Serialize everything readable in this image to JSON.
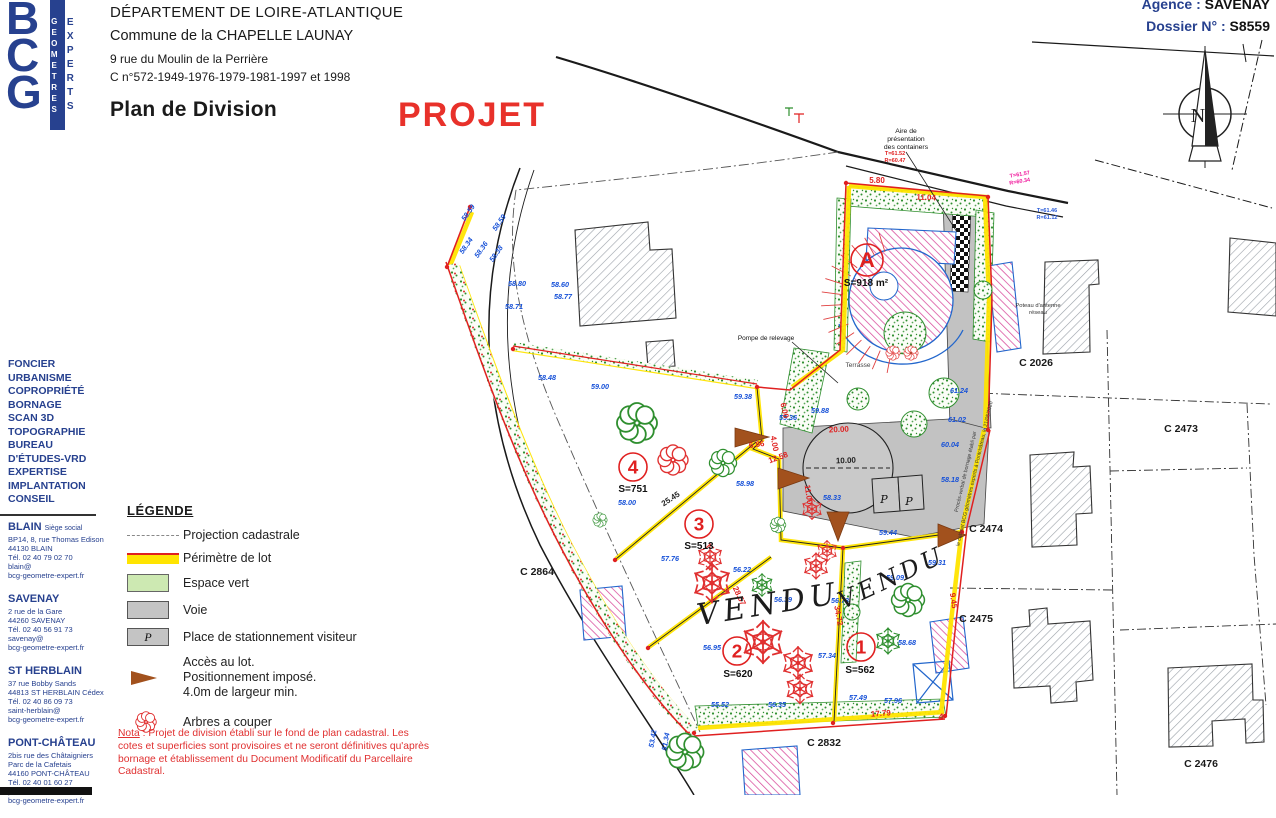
{
  "colors": {
    "brand_blue": "#27418f",
    "stamp_red": "#e8312a",
    "perimeter_yellow": "#ffe400",
    "boundary_red": "#e02020",
    "hedge_green": "#2f8f2f",
    "voie_gray": "#c2c2c2",
    "elevation_blue": "#1550d8",
    "building_pink": "#d84a9b",
    "access_brown": "#a2511d"
  },
  "header": {
    "logo": {
      "monogram": "BCG",
      "vertical_left": "GEOMETRES",
      "vertical_right": "EXPERTS"
    },
    "department": "DÉPARTEMENT DE LOIRE-ATLANTIQUE",
    "commune": "Commune de la CHAPELLE LAUNAY",
    "address": "9 rue du Moulin de la Perrière",
    "cadastre_refs": "C n°572-1949-1976-1979-1981-1997 et 1998",
    "title": "Plan de Division",
    "stamp": "PROJET",
    "agency_label": "Agence :",
    "agency_value": "SAVENAY",
    "dossier_label": "Dossier N° :",
    "dossier_value": "S8559"
  },
  "sidebar": {
    "services": [
      "FONCIER",
      "URBANISME",
      "COPROPRIÉTÉ",
      "BORNAGE",
      "SCAN 3D",
      "TOPOGRAPHIE",
      "BUREAU",
      "D'ÉTUDES-VRD",
      "EXPERTISE",
      "IMPLANTATION",
      "CONSEIL"
    ],
    "offices": [
      {
        "city": "BLAIN",
        "suffix": "Siège social",
        "lines": [
          "BP14, 8, rue Thomas Edison",
          "44130 BLAIN",
          "Tél. 02 40 79 02 70",
          "blain@",
          "bcg-geometre-expert.fr"
        ]
      },
      {
        "city": "SAVENAY",
        "suffix": "",
        "lines": [
          "2 rue de la Gare",
          "44260 SAVENAY",
          "Tél. 02 40 56 91 73",
          "savenay@",
          "bcg-geometre-expert.fr"
        ]
      },
      {
        "city": "ST HERBLAIN",
        "suffix": "",
        "lines": [
          "37 rue Bobby Sands",
          "44813 ST HERBLAIN Cédex",
          "Tél. 02 40 86 09 73",
          "saint-herblain@",
          "bcg-geometre-expert.fr"
        ]
      },
      {
        "city": "PONT-CHÂTEAU",
        "suffix": "",
        "lines": [
          "2bis rue des Châtaigniers",
          "Parc de la Cafetais",
          "44160 PONT-CHÂTEAU",
          "Tél. 02 40 01 60 27",
          "pontchateau@",
          "bcg-geometre-expert.fr"
        ]
      }
    ]
  },
  "legend": {
    "title": "LÉGENDE",
    "p_char": "P",
    "items": [
      {
        "icon": "dash",
        "label": "Projection cadastrale"
      },
      {
        "icon": "band",
        "label": "Périmètre de lot"
      },
      {
        "icon": "green",
        "label": "Espace vert"
      },
      {
        "icon": "gray",
        "label": "Voie"
      },
      {
        "icon": "p",
        "label": "Place de stationnement visiteur"
      },
      {
        "icon": "arrow",
        "lines": [
          "Accès au lot.",
          "Positionnement imposé.",
          "4.0m de largeur min."
        ]
      },
      {
        "icon": "flower",
        "label": "Arbres a couper"
      }
    ]
  },
  "nota": {
    "label": "Nota",
    "body": " : Projet de division établi sur le fond de plan cadastral. Les cotes et superficies sont provisoires et ne seront définitives qu'après bornage et établissement du Document Modificatif du Parcellaire Cadastral."
  },
  "plan": {
    "north": "N",
    "lots": [
      {
        "id": "A",
        "area": "S=918 m²",
        "cx": 867,
        "cy": 260,
        "r": 16,
        "ax": 866,
        "ay": 286
      },
      {
        "id": "4",
        "area": "S=751",
        "cx": 633,
        "cy": 467,
        "r": 14,
        "ax": 633,
        "ay": 492
      },
      {
        "id": "3",
        "area": "S=513",
        "cx": 699,
        "cy": 524,
        "r": 14,
        "ax": 699,
        "ay": 549
      },
      {
        "id": "2",
        "area": "S=620",
        "cx": 737,
        "cy": 651,
        "r": 14,
        "ax": 738,
        "ay": 677
      },
      {
        "id": "1",
        "area": "S=562",
        "cx": 861,
        "cy": 647,
        "r": 14,
        "ax": 860,
        "ay": 673
      }
    ],
    "parcels": [
      [
        "C 2026",
        1036,
        366
      ],
      [
        "C 2473",
        1181,
        432
      ],
      [
        "C 2474",
        986,
        532
      ],
      [
        "C 2475",
        976,
        622
      ],
      [
        "C 2476",
        1201,
        767
      ],
      [
        "C 2832",
        824,
        746
      ],
      [
        "C 2864",
        537,
        575
      ]
    ],
    "annotations": [
      {
        "t": "Aire de",
        "x": 906,
        "y": 133,
        "s": 6.8
      },
      {
        "t": "présentation",
        "x": 906,
        "y": 141,
        "s": 6.8
      },
      {
        "t": "des containers",
        "x": 906,
        "y": 149,
        "s": 6.8
      },
      {
        "t": "Pompe de relevage",
        "x": 766,
        "y": 340,
        "s": 6.5
      },
      {
        "t": "Terrasse",
        "x": 858,
        "y": 367,
        "s": 6.5,
        "c": "#444"
      },
      {
        "t": "Poteau d'antenne",
        "x": 1038,
        "y": 307,
        "s": 5.8,
        "c": "#333"
      },
      {
        "t": "réseau",
        "x": 1038,
        "y": 314,
        "s": 5.8,
        "c": "#333"
      },
      {
        "t": "VENDU",
        "x": 770,
        "y": 614,
        "s": 30,
        "r": -9,
        "f": "DejaVu Serif, serif",
        "i": 1,
        "ls": 5,
        "c": "#1c1c1c"
      },
      {
        "t": "VENDU",
        "x": 895,
        "y": 585,
        "s": 24,
        "r": -25,
        "f": "DejaVu Serif, serif",
        "i": 1,
        "ls": 4,
        "c": "#1c1c1c"
      },
      {
        "t": "Procès-verbal de bornage établi par",
        "x": 967,
        "y": 472,
        "s": 5.2,
        "r": -77,
        "c": "#333"
      },
      {
        "t": "le cabinet BCG géomètres experts à Pontchâteau, le 21/05/2020",
        "x": 976,
        "y": 474,
        "s": 5.2,
        "r": -77,
        "c": "#333"
      },
      {
        "t": "P",
        "x": 884,
        "y": 503,
        "s": 11,
        "f": "DejaVu Serif, serif",
        "i": 1
      },
      {
        "t": "P",
        "x": 909,
        "y": 505,
        "s": 11,
        "f": "DejaVu Serif, serif",
        "i": 1
      }
    ],
    "measures": [
      [
        "5.80",
        877,
        183,
        0
      ],
      [
        "11.04",
        926,
        200,
        3
      ],
      [
        "T=61.52",
        895,
        155,
        0,
        5.5
      ],
      [
        "R=60.47",
        895,
        162,
        0,
        5.5
      ],
      [
        "T=61.57",
        1020,
        176,
        -10,
        5.5,
        "#f0189c"
      ],
      [
        "R=60.34",
        1020,
        183,
        -10,
        5.5,
        "#f0189c"
      ],
      [
        "T=61.46",
        1047,
        212,
        0,
        5.5,
        "#2659d8"
      ],
      [
        "R=61.12",
        1047,
        219,
        0,
        5.5,
        "#2659d8"
      ],
      [
        "6.00",
        782,
        411,
        78
      ],
      [
        "4.00",
        772,
        444,
        80
      ],
      [
        "6.86",
        757,
        447,
        -8
      ],
      [
        "12.58",
        779,
        460,
        -20
      ],
      [
        "11.00",
        806,
        495,
        82
      ],
      [
        "20.00",
        839,
        432,
        -3
      ],
      [
        "28.57",
        737,
        597,
        64
      ],
      [
        "34.72",
        836,
        616,
        80
      ],
      [
        "9.45",
        951,
        601,
        82
      ],
      [
        "17.79",
        881,
        716,
        -4
      ],
      [
        "4",
        941,
        720,
        0,
        9
      ],
      [
        "25.45",
        672,
        501,
        -33,
        8,
        "#222"
      ],
      [
        "10.00",
        846,
        463,
        -2,
        8,
        "#222"
      ]
    ],
    "elevations": [
      [
        "58.59",
        470,
        214,
        -55
      ],
      [
        "58.59",
        501,
        224,
        -55
      ],
      [
        "58.34",
        468,
        247,
        -55
      ],
      [
        "58.36",
        483,
        251,
        -55
      ],
      [
        "58.38",
        498,
        255,
        -55
      ],
      [
        "58.80",
        517,
        286,
        0
      ],
      [
        "58.71",
        514,
        309,
        0
      ],
      [
        "58.60",
        560,
        287,
        0
      ],
      [
        "58.77",
        563,
        299,
        0
      ],
      [
        "58.48",
        547,
        380,
        0
      ],
      [
        "59.00",
        600,
        389,
        0
      ],
      [
        "59.38",
        743,
        399,
        0
      ],
      [
        "59.36",
        788,
        420,
        0
      ],
      [
        "59.88",
        820,
        413,
        0
      ],
      [
        "58.98",
        745,
        486,
        0
      ],
      [
        "58.00",
        627,
        505,
        0
      ],
      [
        "57.76",
        670,
        561,
        0
      ],
      [
        "56.22",
        742,
        572,
        0
      ],
      [
        "56.39",
        783,
        602,
        0
      ],
      [
        "56.73",
        840,
        603,
        0
      ],
      [
        "56.95",
        712,
        650,
        0
      ],
      [
        "57.34",
        827,
        658,
        0
      ],
      [
        "58.68",
        907,
        645,
        0
      ],
      [
        "55.52",
        720,
        707,
        0
      ],
      [
        "56.35",
        777,
        707,
        0
      ],
      [
        "57.49",
        858,
        700,
        0
      ],
      [
        "57.96",
        893,
        703,
        0
      ],
      [
        "59.31",
        937,
        565,
        0
      ],
      [
        "59.09",
        895,
        580,
        0
      ],
      [
        "61.02",
        957,
        422,
        0
      ],
      [
        "60.04",
        950,
        447,
        0
      ],
      [
        "58.18",
        950,
        482,
        0
      ],
      [
        "59.44",
        888,
        535,
        0
      ],
      [
        "58.33",
        832,
        500,
        0
      ],
      [
        "61.24",
        959,
        393,
        0
      ],
      [
        "53.42",
        655,
        739,
        -80
      ],
      [
        "51.34",
        668,
        742,
        -80
      ]
    ],
    "trees": [
      [
        "snow",
        "#e03030",
        712,
        583,
        1.2
      ],
      [
        "snow",
        "#e03030",
        763,
        642,
        1.3
      ],
      [
        "snow",
        "#e03030",
        798,
        663,
        1.0
      ],
      [
        "snow",
        "#e03030",
        816,
        566,
        0.8
      ],
      [
        "snow",
        "#e03030",
        800,
        689,
        0.9
      ],
      [
        "snow",
        "#e03030",
        710,
        557,
        0.8
      ],
      [
        "snow",
        "#e03030",
        827,
        551,
        0.65
      ],
      [
        "snow",
        "#e03030",
        812,
        509,
        0.65
      ],
      [
        "snow",
        "#2f8f2f",
        762,
        585,
        0.7
      ],
      [
        "snow",
        "#2f8f2f",
        888,
        641,
        0.8
      ],
      [
        "flower",
        "#2f8f2f",
        637,
        423,
        1.4
      ],
      [
        "flower",
        "#2f8f2f",
        723,
        463,
        0.95
      ],
      [
        "flower",
        "#2f8f2f",
        908,
        600,
        1.15
      ],
      [
        "flower",
        "#2f8f2f",
        685,
        752,
        1.3
      ],
      [
        "flower",
        "#2f8f2f",
        600,
        520,
        0.5
      ],
      [
        "flower",
        "#2f8f2f",
        778,
        525,
        0.55
      ],
      [
        "flower",
        "#e03030",
        673,
        460,
        1.05
      ],
      [
        "flower",
        "#e03030",
        893,
        353,
        0.5
      ],
      [
        "flower",
        "#e03030",
        911,
        353,
        0.5
      ]
    ],
    "bushes": [
      [
        905,
        333,
        21
      ],
      [
        944,
        393,
        15
      ],
      [
        914,
        424,
        13
      ],
      [
        858,
        399,
        11
      ],
      [
        983,
        290,
        9
      ],
      [
        852,
        612,
        8
      ]
    ],
    "accesses": [
      [
        735,
        428,
        735,
        447,
        769,
        437
      ],
      [
        778,
        468,
        778,
        489,
        809,
        478
      ],
      [
        827,
        512,
        849,
        512,
        838,
        541
      ],
      [
        938,
        524,
        938,
        547,
        966,
        535
      ]
    ],
    "bornes": [
      [
        447,
        267
      ],
      [
        470,
        207
      ],
      [
        513,
        349
      ],
      [
        757,
        387
      ],
      [
        846,
        183
      ],
      [
        988,
        197
      ],
      [
        988,
        430
      ],
      [
        843,
        548
      ],
      [
        833,
        723
      ],
      [
        945,
        716
      ],
      [
        694,
        733
      ],
      [
        615,
        560
      ],
      [
        648,
        648
      ],
      [
        962,
        532
      ]
    ]
  }
}
